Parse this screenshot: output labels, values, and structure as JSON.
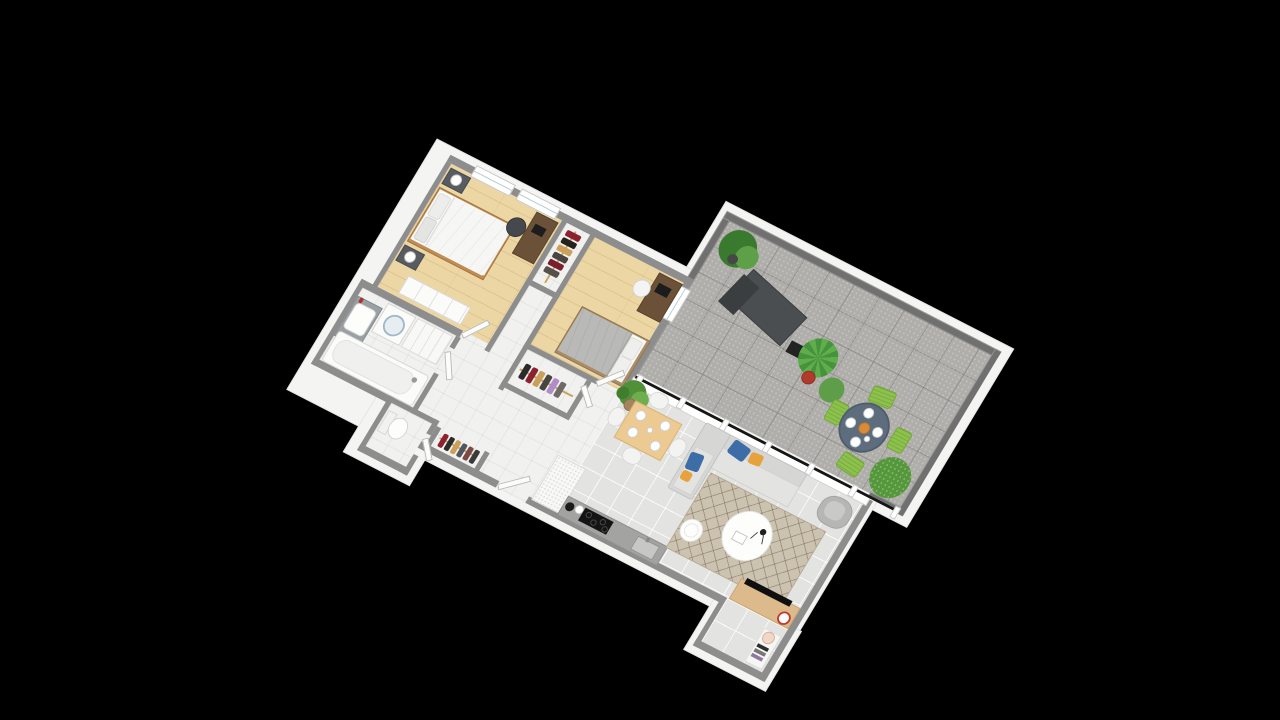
{
  "scene": {
    "type": "isometric-3d-floor-plan",
    "background_color": "#000000",
    "wall_top_color": "#8d8d8d",
    "terrace_parapet_color": "#707070",
    "slab_color": "#f4f4f2"
  },
  "palette": {
    "wood_floor": "#ecd7a4",
    "white_tile_floor": "#f1f1ef",
    "gray_tile_floor": "#e3e3e1",
    "terrace_tile_floor": "#b0aeaa",
    "sofa_gray": "#e3e3e1",
    "cushion_blue": "#3c6da6",
    "cushion_orange": "#e6a23c",
    "outdoor_chair_green": "#8cc24c",
    "outdoor_table_blue_gray": "#5d6d7d",
    "bed1_duvet": "#f6f6f4",
    "bed2_duvet": "#b9b9b7",
    "rug_beige": "#ccc2b0",
    "tv_unit_wood": "#dcba8c",
    "accent_red": "#c0392b"
  },
  "rooms": [
    {
      "name": "bedroom-1",
      "floor": "wood",
      "furniture": [
        "double-bed",
        "nightstand-top",
        "nightstand-bottom",
        "table-lamp-1",
        "table-lamp-2",
        "desk",
        "desk-chair",
        "chest-of-drawers",
        "wardrobe-with-clothes",
        "window-1",
        "window-2"
      ]
    },
    {
      "name": "bedroom-2",
      "floor": "wood",
      "furniture": [
        "bed",
        "desk",
        "laptop",
        "desk-chair",
        "walk-in-closet-with-clothes",
        "window"
      ]
    },
    {
      "name": "bathroom",
      "floor": "white-tile",
      "furniture": [
        "vanity-sink",
        "washing-machine",
        "drawer-cabinet",
        "bathtub"
      ]
    },
    {
      "name": "wc",
      "floor": "white-tile",
      "furniture": [
        "toilet"
      ]
    },
    {
      "name": "hallway",
      "floor": "white-tile",
      "furniture": [
        "coat-closet-with-clothes",
        "entrance-door"
      ]
    },
    {
      "name": "kitchen",
      "floor": "gray-tile",
      "furniture": [
        "refrigerator",
        "countertop",
        "induction-hob",
        "kitchen-sink",
        "kettle"
      ]
    },
    {
      "name": "living-dining",
      "floor": "gray-tile",
      "furniture": [
        "dining-table",
        "dining-chairs-x4",
        "plates-x4",
        "corner-sofa",
        "cushions-blue-orange",
        "area-rug",
        "round-coffee-table",
        "floor-lamp",
        "side-table",
        "armchair",
        "tv-sideboard",
        "tv",
        "bookshelf",
        "potted-plant"
      ]
    },
    {
      "name": "terrace",
      "floor": "outdoor-tile",
      "furniture": [
        "sun-lounger",
        "outdoor-side-table",
        "round-outdoor-table",
        "green-chairs-x4",
        "potted-plant-large",
        "potted-palm",
        "red-planter",
        "bush",
        "glass-balustrade"
      ]
    }
  ]
}
